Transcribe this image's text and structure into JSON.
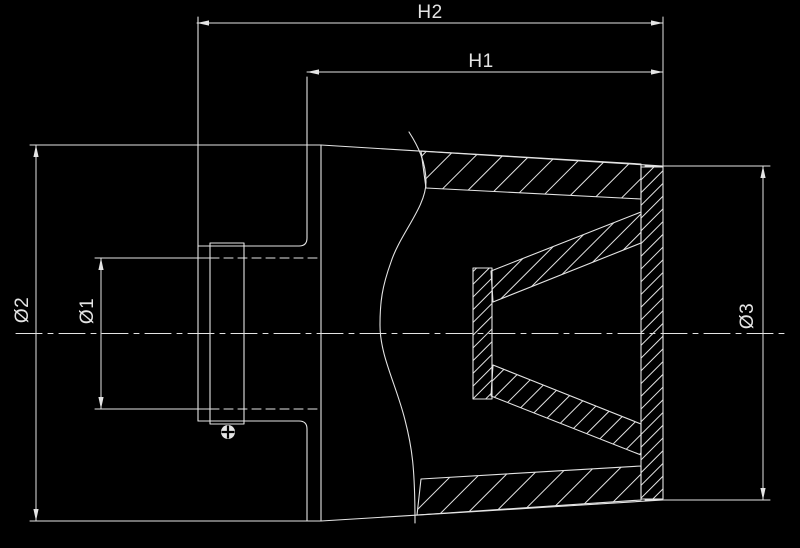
{
  "meta": {
    "title": "Conical air filter cross-section technical drawing",
    "background": "#000000",
    "stroke": "#e4e4e4",
    "screw_slot_color": "#000000"
  },
  "labels": {
    "h2": "H2",
    "h1": "H1",
    "d1": "Ø1",
    "d2": "Ø2",
    "d3": "Ø3"
  }
}
